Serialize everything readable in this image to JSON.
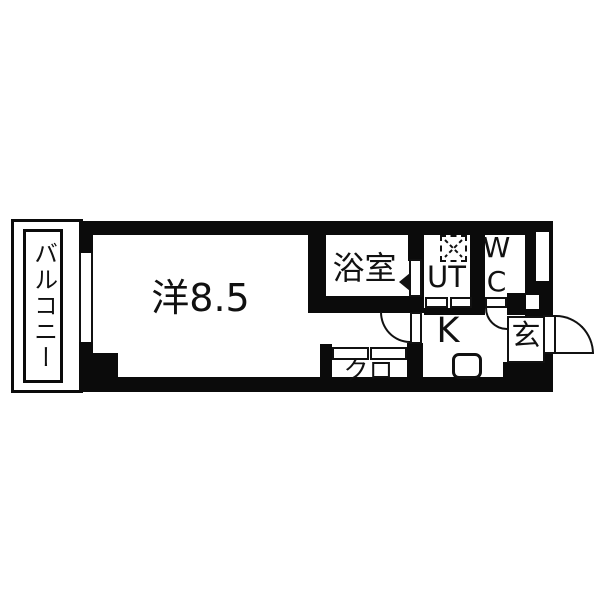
{
  "title": "apartment-floor-plan",
  "colors": {
    "wall": "#0b0b0b",
    "floor": "#ffffff",
    "line": "#111111"
  },
  "rooms": {
    "balcony": {
      "label": "バルコニー"
    },
    "main_room": {
      "label": "洋8.5"
    },
    "bathroom": {
      "label": "浴室"
    },
    "utility": {
      "label": "UT"
    },
    "toilet": {
      "label": "WC"
    },
    "kitchen": {
      "label": "K"
    },
    "closet": {
      "label": "クロ"
    },
    "entrance": {
      "label": "玄"
    }
  },
  "icons": {
    "washing_machine": "washing-machine-placement-dashed-square",
    "sink": "kitchen-sink",
    "bath_door_swing": "door-swing-triangle",
    "front_door": "hinged-door-quarter-arc",
    "room_door": "hinged-door-quarter-arc",
    "wc_door": "hinged-door-quarter-arc",
    "closet_door": "sliding-door-two-panels",
    "utility_door": "folding-door-two-panels",
    "balcony_window": "sliding-window"
  }
}
